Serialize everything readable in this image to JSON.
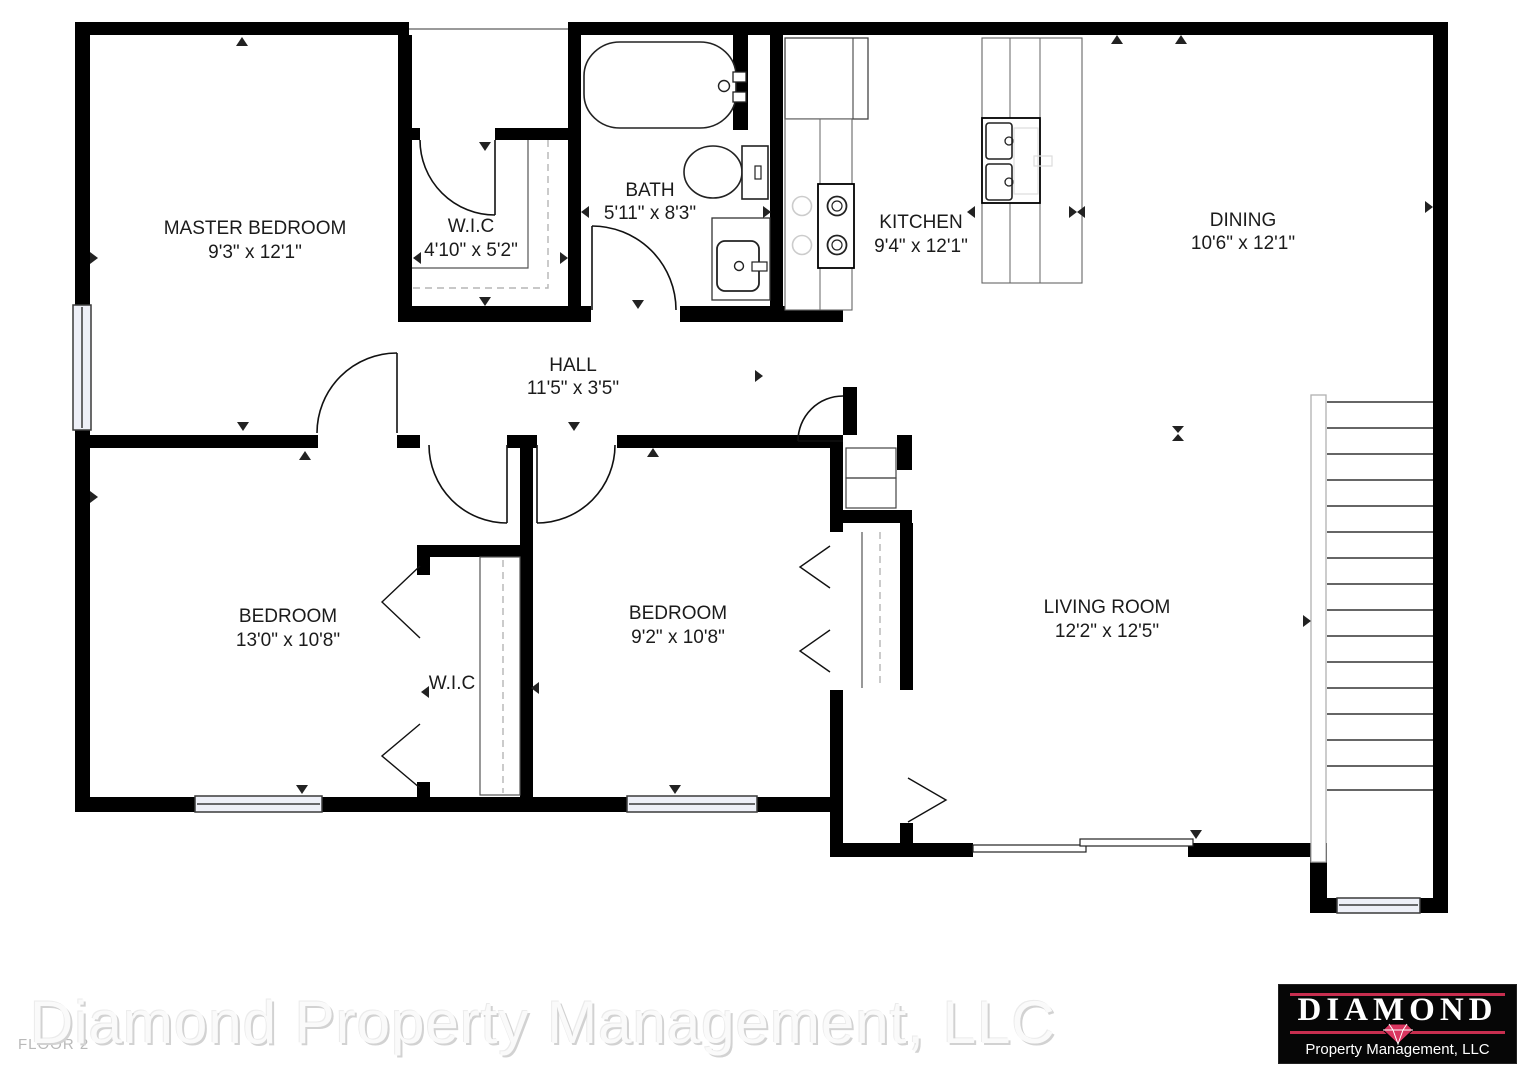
{
  "plan": {
    "floor_label": "FLOOR 2",
    "rooms": [
      {
        "name": "MASTER BEDROOM",
        "dims": "9'3\" x 12'1\""
      },
      {
        "name": "W.I.C",
        "dims": "4'10\" x 5'2\""
      },
      {
        "name": "BATH",
        "dims": "5'11\" x 8'3\""
      },
      {
        "name": "KITCHEN",
        "dims": "9'4\" x 12'1\""
      },
      {
        "name": "DINING",
        "dims": "10'6\" x 12'1\""
      },
      {
        "name": "HALL",
        "dims": "11'5\" x 3'5\""
      },
      {
        "name": "BEDROOM",
        "dims": "13'0\" x 10'8\""
      },
      {
        "name": "W.I.C",
        "dims": ""
      },
      {
        "name": "BEDROOM",
        "dims": "9'2\" x 10'8\""
      },
      {
        "name": "LIVING ROOM",
        "dims": "12'2\" x 12'5\""
      }
    ]
  },
  "watermark": "Diamond Property Management, LLC",
  "logo": {
    "title": "DIAMOND",
    "subtitle": "Property Management, LLC",
    "colors": {
      "background": "#060606",
      "text": "#ffffff",
      "accent_line": "#c72e4f",
      "gem": "#da3560"
    }
  },
  "colors": {
    "wall": "#000000",
    "label_text": "#1b1b1b",
    "window_fill": "#eef0f8",
    "dashed_line": "#aaaaaa"
  }
}
